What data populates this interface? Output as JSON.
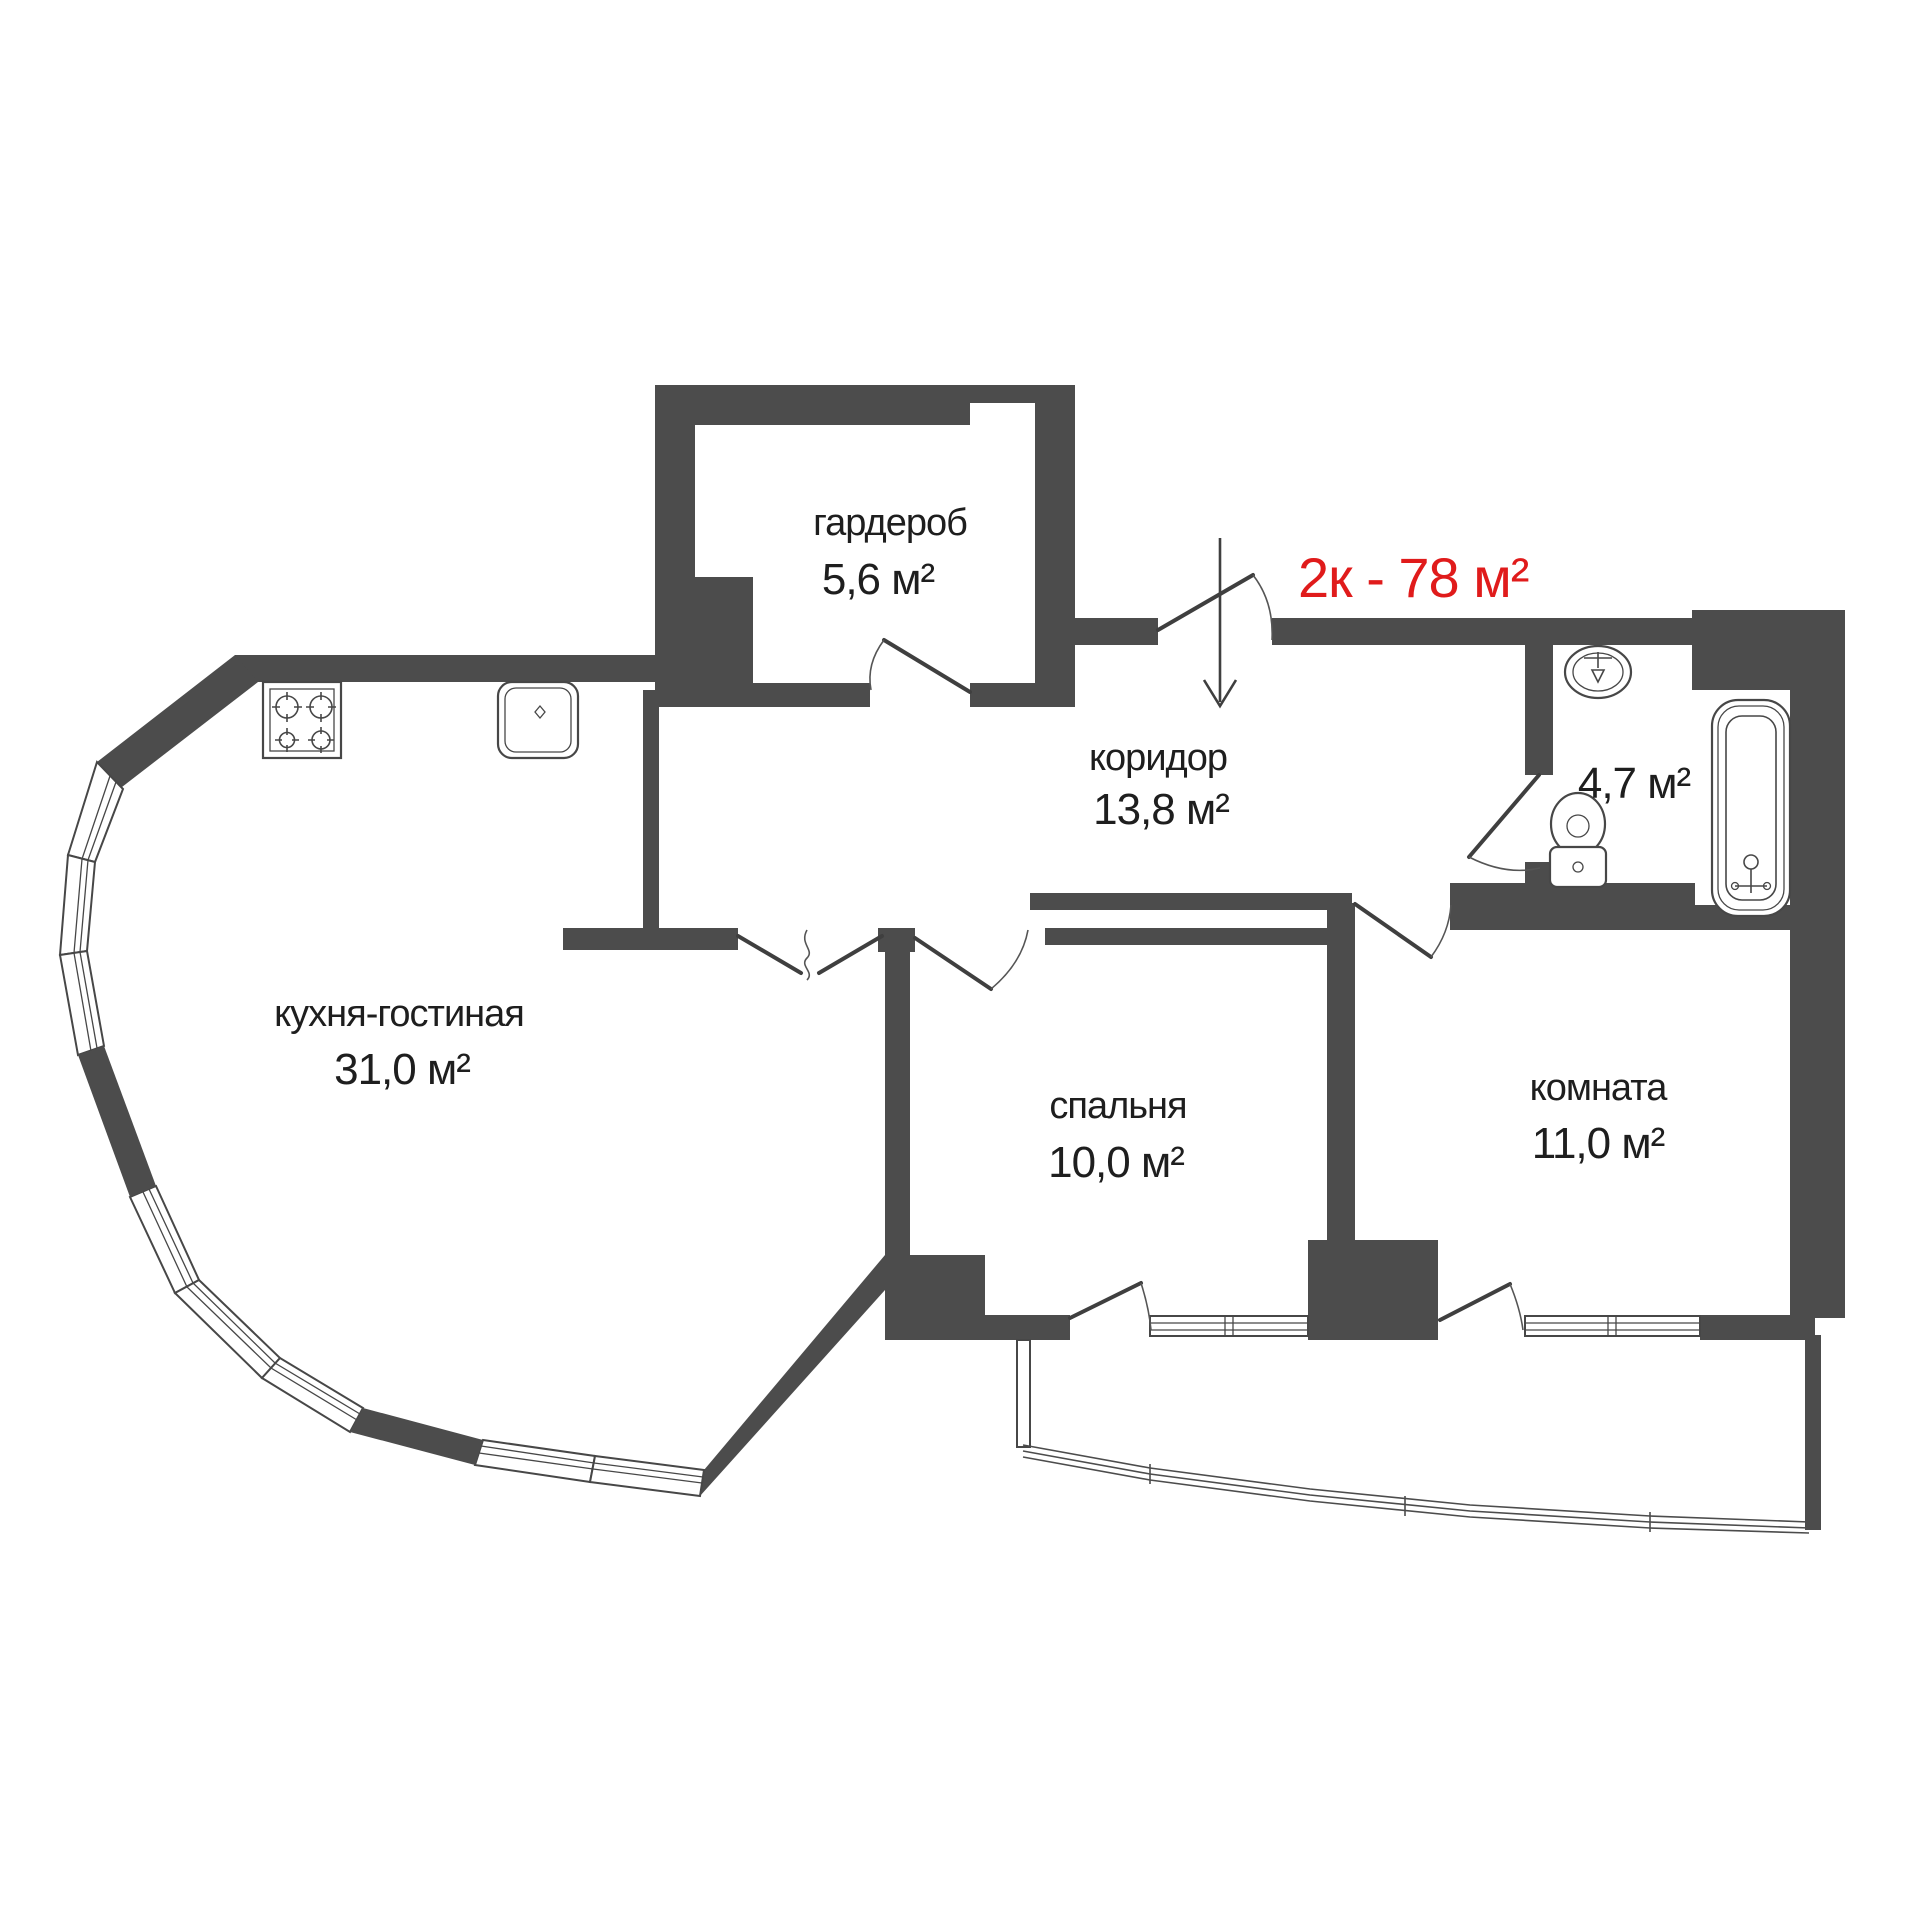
{
  "plan": {
    "title": "2к - 78 м²",
    "title_color": "#e01b1b",
    "rooms": [
      {
        "name": "гардероб",
        "area": "5,6 м²"
      },
      {
        "name": "коридор",
        "area": "13,8 м²"
      },
      {
        "name": "",
        "area": "4,7 м²"
      },
      {
        "name": "кухня-гостиная",
        "area": "31,0 м²"
      },
      {
        "name": "спальня",
        "area": "10,0 м²"
      },
      {
        "name": "комната",
        "area": "11,0 м²"
      }
    ],
    "fixtures": [
      "stove-icon",
      "kitchen-sink-icon",
      "washbasin-icon",
      "toilet-icon",
      "bathtub-icon"
    ],
    "entry_arrow": "↓"
  },
  "colors": {
    "wall": "#4c4c4c",
    "line": "#474747",
    "text": "#1e1e1e",
    "accent_red": "#e01b1b",
    "background": "#ffffff"
  }
}
